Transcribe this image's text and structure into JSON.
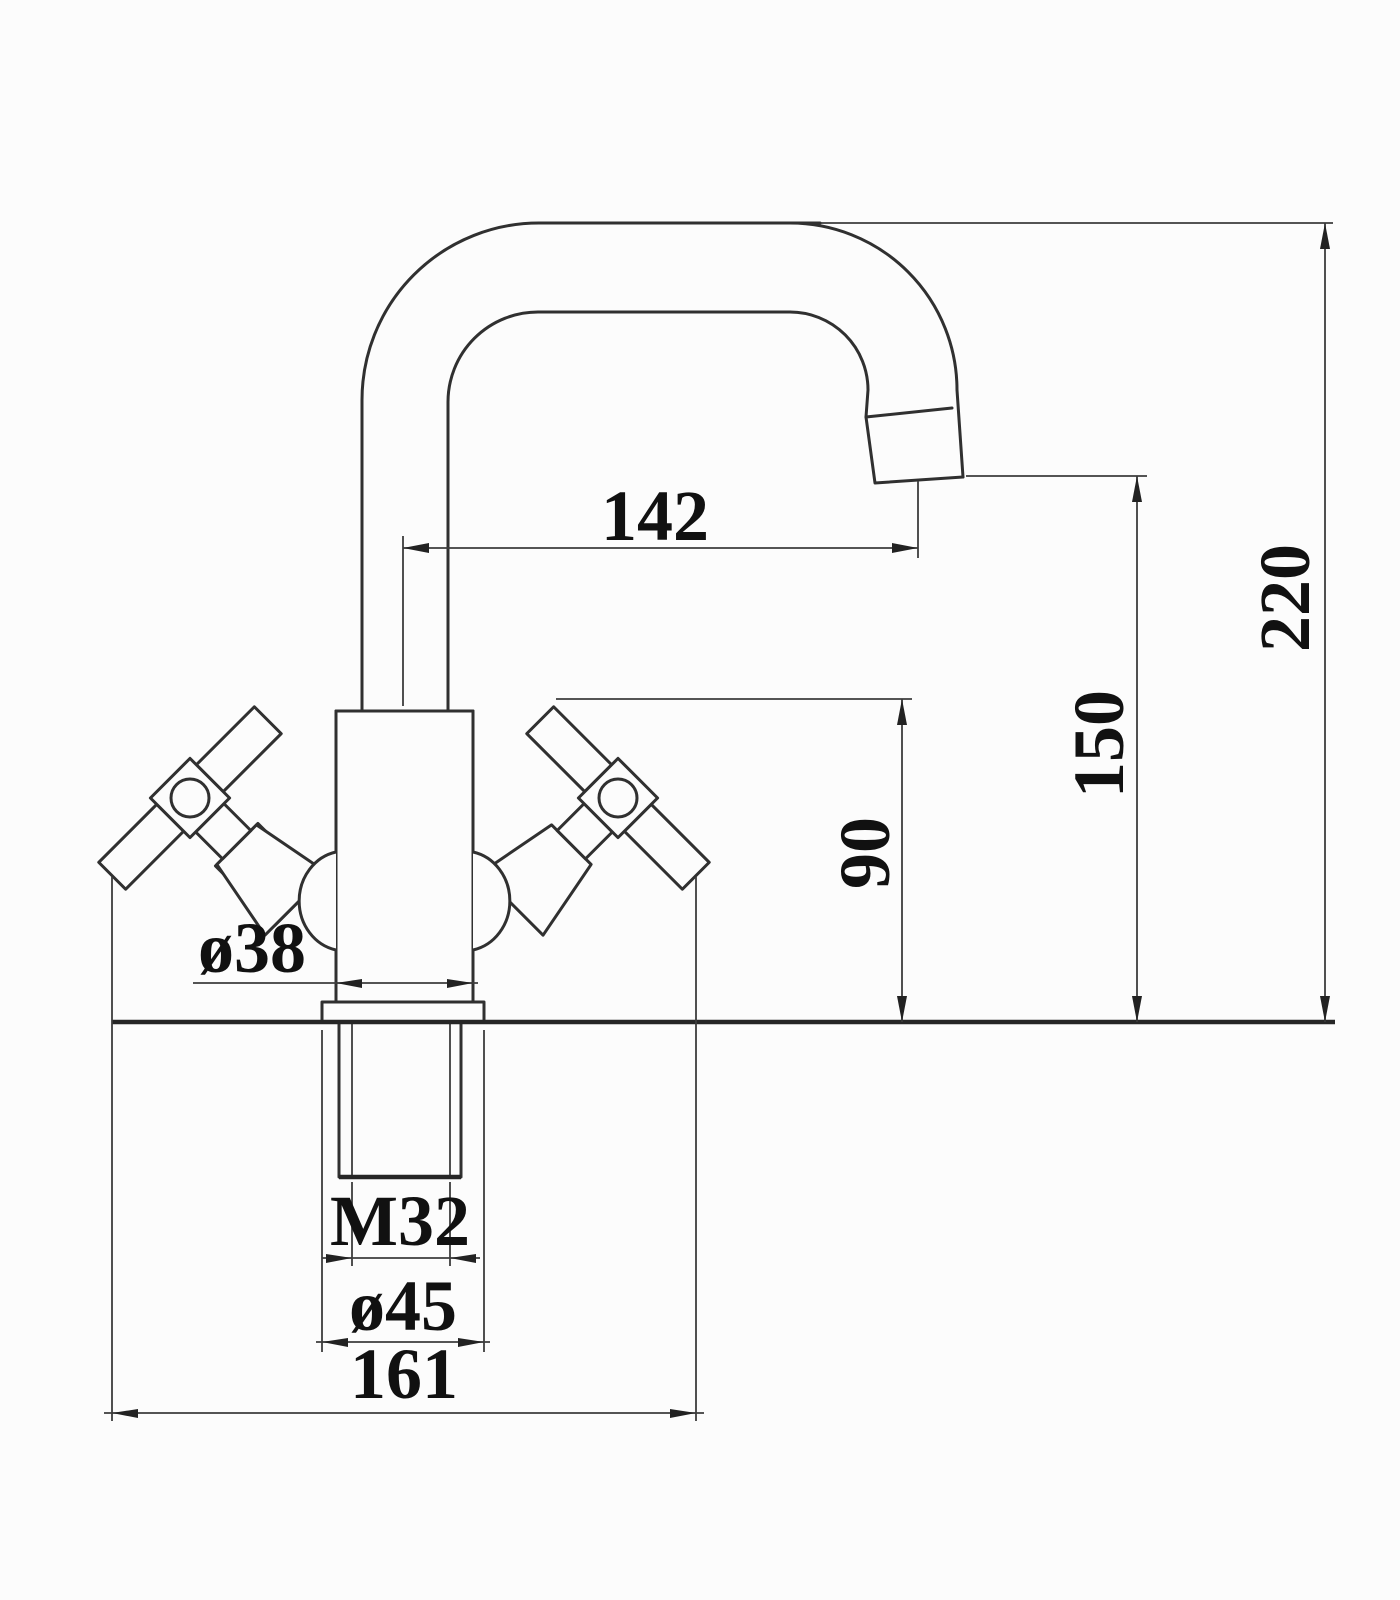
{
  "drawing": {
    "type": "technical-dimension-diagram",
    "subject": "single-hole basin mixer tap, front elevation with swivel spout and two cross handles",
    "background_color": "#fcfcfc",
    "line_color": "#303030",
    "dimension_line_color": "#3d3d3d",
    "text_color": "#111111",
    "dimensions": {
      "spout_reach": {
        "label": "142",
        "orientation": "horizontal",
        "measures": "centerline of riser to spout outlet"
      },
      "overall_height": {
        "label": "220",
        "orientation": "vertical",
        "measures": "deck to top of spout"
      },
      "outlet_height": {
        "label": "150",
        "orientation": "vertical",
        "measures": "deck to spout outlet"
      },
      "handle_height": {
        "label": "90",
        "orientation": "vertical",
        "measures": "deck to handle tip"
      },
      "body_diameter": {
        "label": "ø38",
        "orientation": "leader",
        "measures": "body diameter"
      },
      "thread_size": {
        "label": "M32",
        "orientation": "horizontal",
        "measures": "mounting thread"
      },
      "flange_diameter": {
        "label": "ø45",
        "orientation": "horizontal",
        "measures": "base flange diameter"
      },
      "base_spread": {
        "label": "161",
        "orientation": "horizontal",
        "measures": "overall width across handles"
      }
    }
  }
}
